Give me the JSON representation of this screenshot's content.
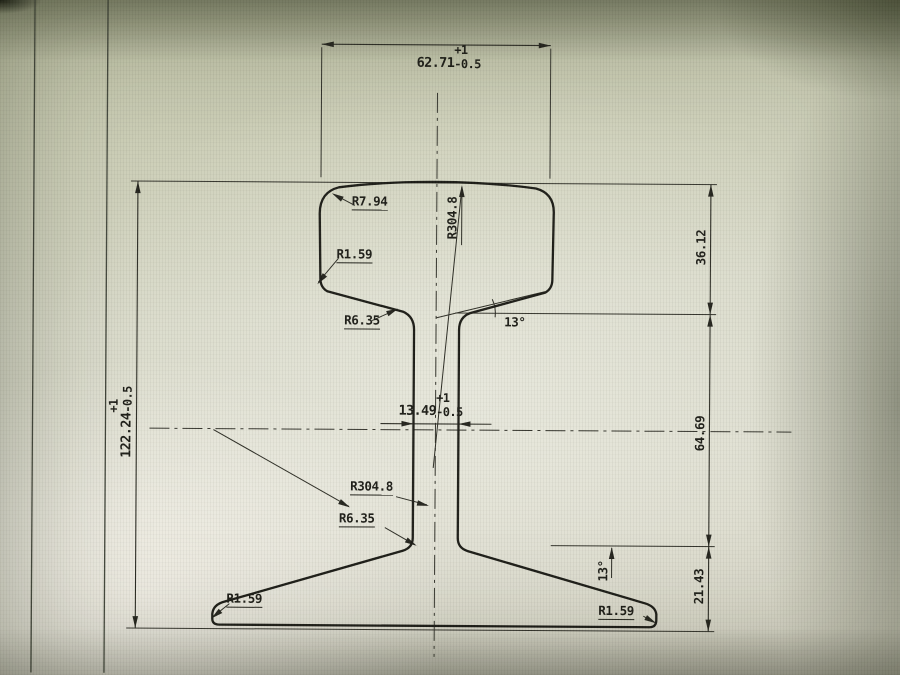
{
  "drawing": {
    "dimensions": {
      "head_width": {
        "main": "62.71",
        "tol_top": "+1",
        "tol_bottom": "-0.5"
      },
      "total_height": {
        "main": "122.24",
        "tol_top": "+1",
        "tol_bottom": "-0.5"
      },
      "web_thickness": {
        "main": "13.49",
        "tol_top": "+1",
        "tol_bottom": "-0.5"
      },
      "head_depth": "36.12",
      "web_zone_height": "64.69",
      "base_height": "21.43"
    },
    "labels": {
      "head_corner_radius": "R7.94",
      "head_side_radius": "R1.59",
      "head_web_fillet": "R6.35",
      "crown_radius": "R304.8",
      "web_radius": "R304.8",
      "web_base_fillet": "R6.35",
      "base_left_radius": "R1.59",
      "base_right_radius": "R1.59",
      "head_angle": "13°",
      "base_angle": "13°"
    }
  }
}
